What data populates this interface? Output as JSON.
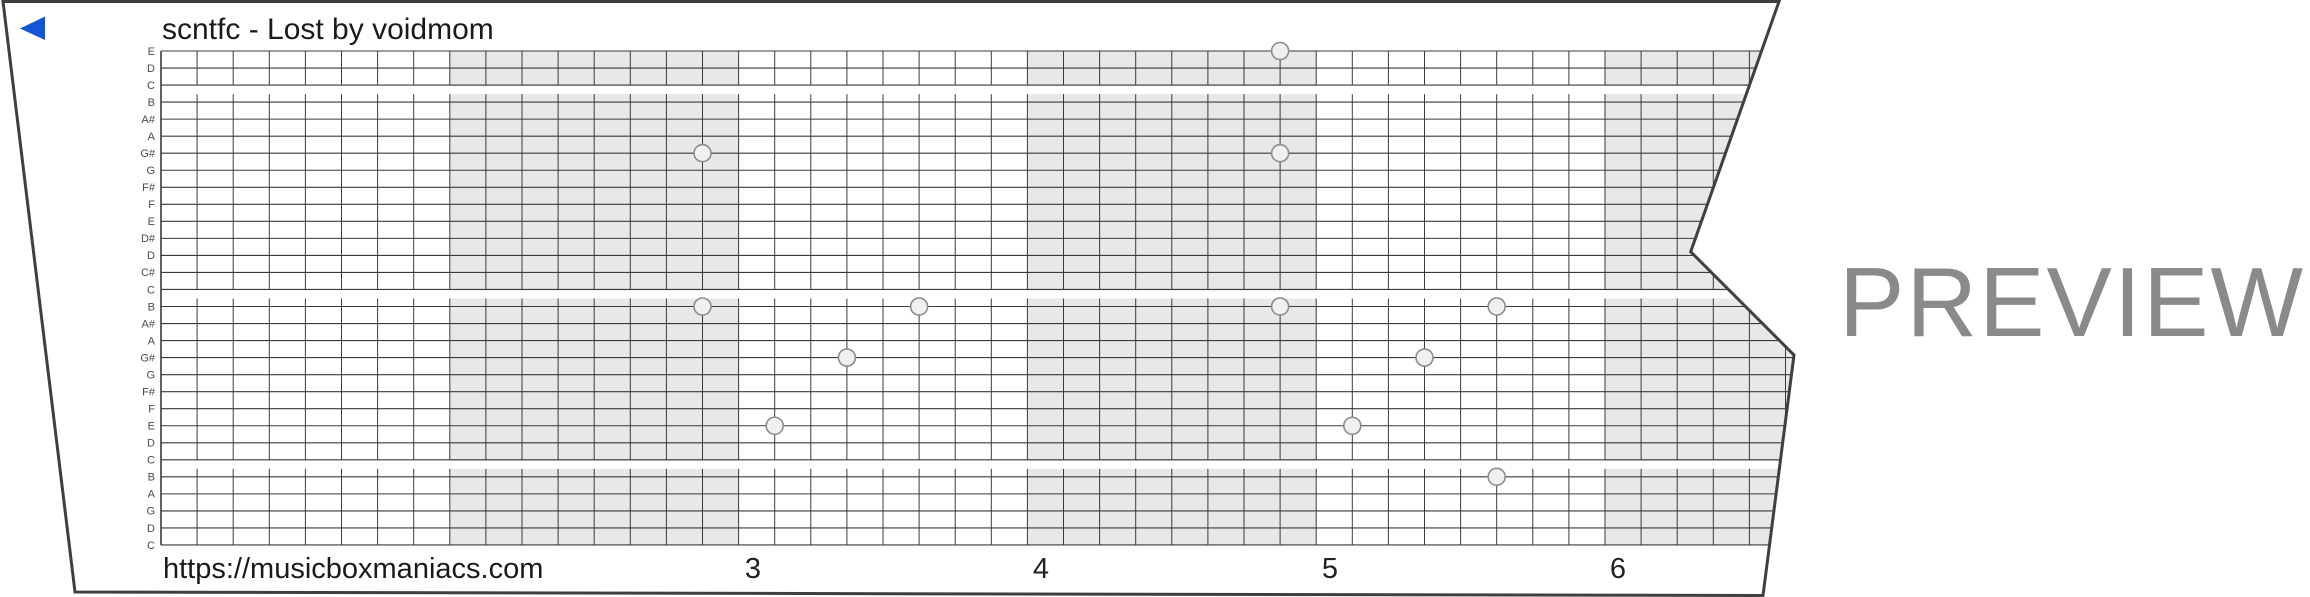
{
  "title": "scntfc - Lost by voidmom",
  "watermark": "PREVIEW",
  "footer": {
    "url": "https://musicboxmaniacs.com",
    "measure_numbers": [
      "3",
      "4",
      "5",
      "6"
    ]
  },
  "colors": {
    "accent_blue": "#1255d7",
    "band_gray": "#e8e8e8",
    "grid_line": "#3a3a3a",
    "border": "#3f3f3f",
    "watermark_gray": "#8a8a8a",
    "hole_fill": "#f0f0f0",
    "hole_stroke": "#8d8d8d",
    "label_color": "#4a4a4a",
    "number_color": "#222222",
    "strip_fill": "#ffffff",
    "octave_stripe": "#ffffff"
  },
  "note_labels": [
    "E",
    "D",
    "C",
    "B",
    "A#",
    "A",
    "G#",
    "G",
    "F#",
    "F",
    "E",
    "D#",
    "D",
    "C#",
    "C",
    "B",
    "A#",
    "A",
    "G#",
    "G",
    "F#",
    "F",
    "E",
    "D",
    "C",
    "B",
    "A",
    "G",
    "D",
    "C"
  ],
  "octave_break_after_lines": [
    3,
    15,
    25
  ],
  "grid": {
    "left": 161,
    "top": 51,
    "bottom": 545,
    "row_spacing": 17.034,
    "col_width": 36.1,
    "rows": 30,
    "cols": 48,
    "measure_cols": 8,
    "shaded_measure_start_cols": [
      8,
      24,
      40
    ]
  },
  "strip_outline": "3,1.5 1779,1.5 1690.7,251.7 1794,355 1763,595.5 75,592",
  "play_triangle": "20,28.5 45,16.5 45,40",
  "hole_radius": 8.5,
  "notes": [
    {
      "note": "E",
      "line": 1,
      "col": 31
    },
    {
      "note": "G#",
      "line": 7,
      "col": 15
    },
    {
      "note": "G#",
      "line": 7,
      "col": 31
    },
    {
      "note": "B",
      "line": 16,
      "col": 15
    },
    {
      "note": "B",
      "line": 16,
      "col": 21
    },
    {
      "note": "B",
      "line": 16,
      "col": 31
    },
    {
      "note": "B",
      "line": 16,
      "col": 37
    },
    {
      "note": "G#",
      "line": 19,
      "col": 19
    },
    {
      "note": "G#",
      "line": 19,
      "col": 35
    },
    {
      "note": "E",
      "line": 23,
      "col": 17
    },
    {
      "note": "E",
      "line": 23,
      "col": 33
    },
    {
      "note": "B",
      "line": 26,
      "col": 37
    }
  ],
  "measure_number_x": [
    753,
    1041,
    1330,
    1618
  ],
  "measure_number_baseline": 578
}
